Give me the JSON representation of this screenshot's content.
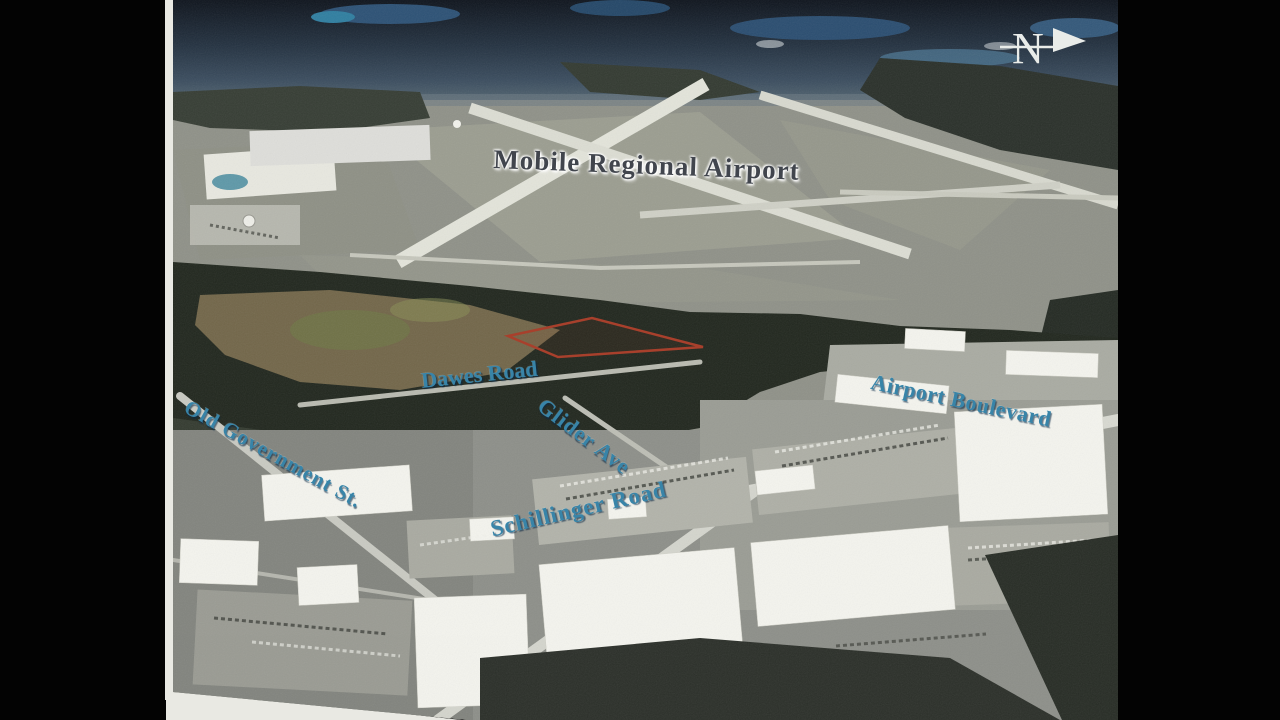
{
  "compass": {
    "letter": "N"
  },
  "map": {
    "title": "Mobile Regional Airport",
    "road_labels": [
      {
        "name": "Dawes Road"
      },
      {
        "name": "Glider Ave"
      },
      {
        "name": "Airport Boulevard"
      },
      {
        "name": "Old Government St."
      },
      {
        "name": "Schillinger Road"
      }
    ]
  },
  "colors": {
    "label_blue": "#3884a8",
    "title_gray": "#41454d",
    "parcel_red": "#a8402c",
    "compass_white": "#e9ece9",
    "scan_white": "#e9e9e3",
    "backdrop_black": "#000000"
  }
}
